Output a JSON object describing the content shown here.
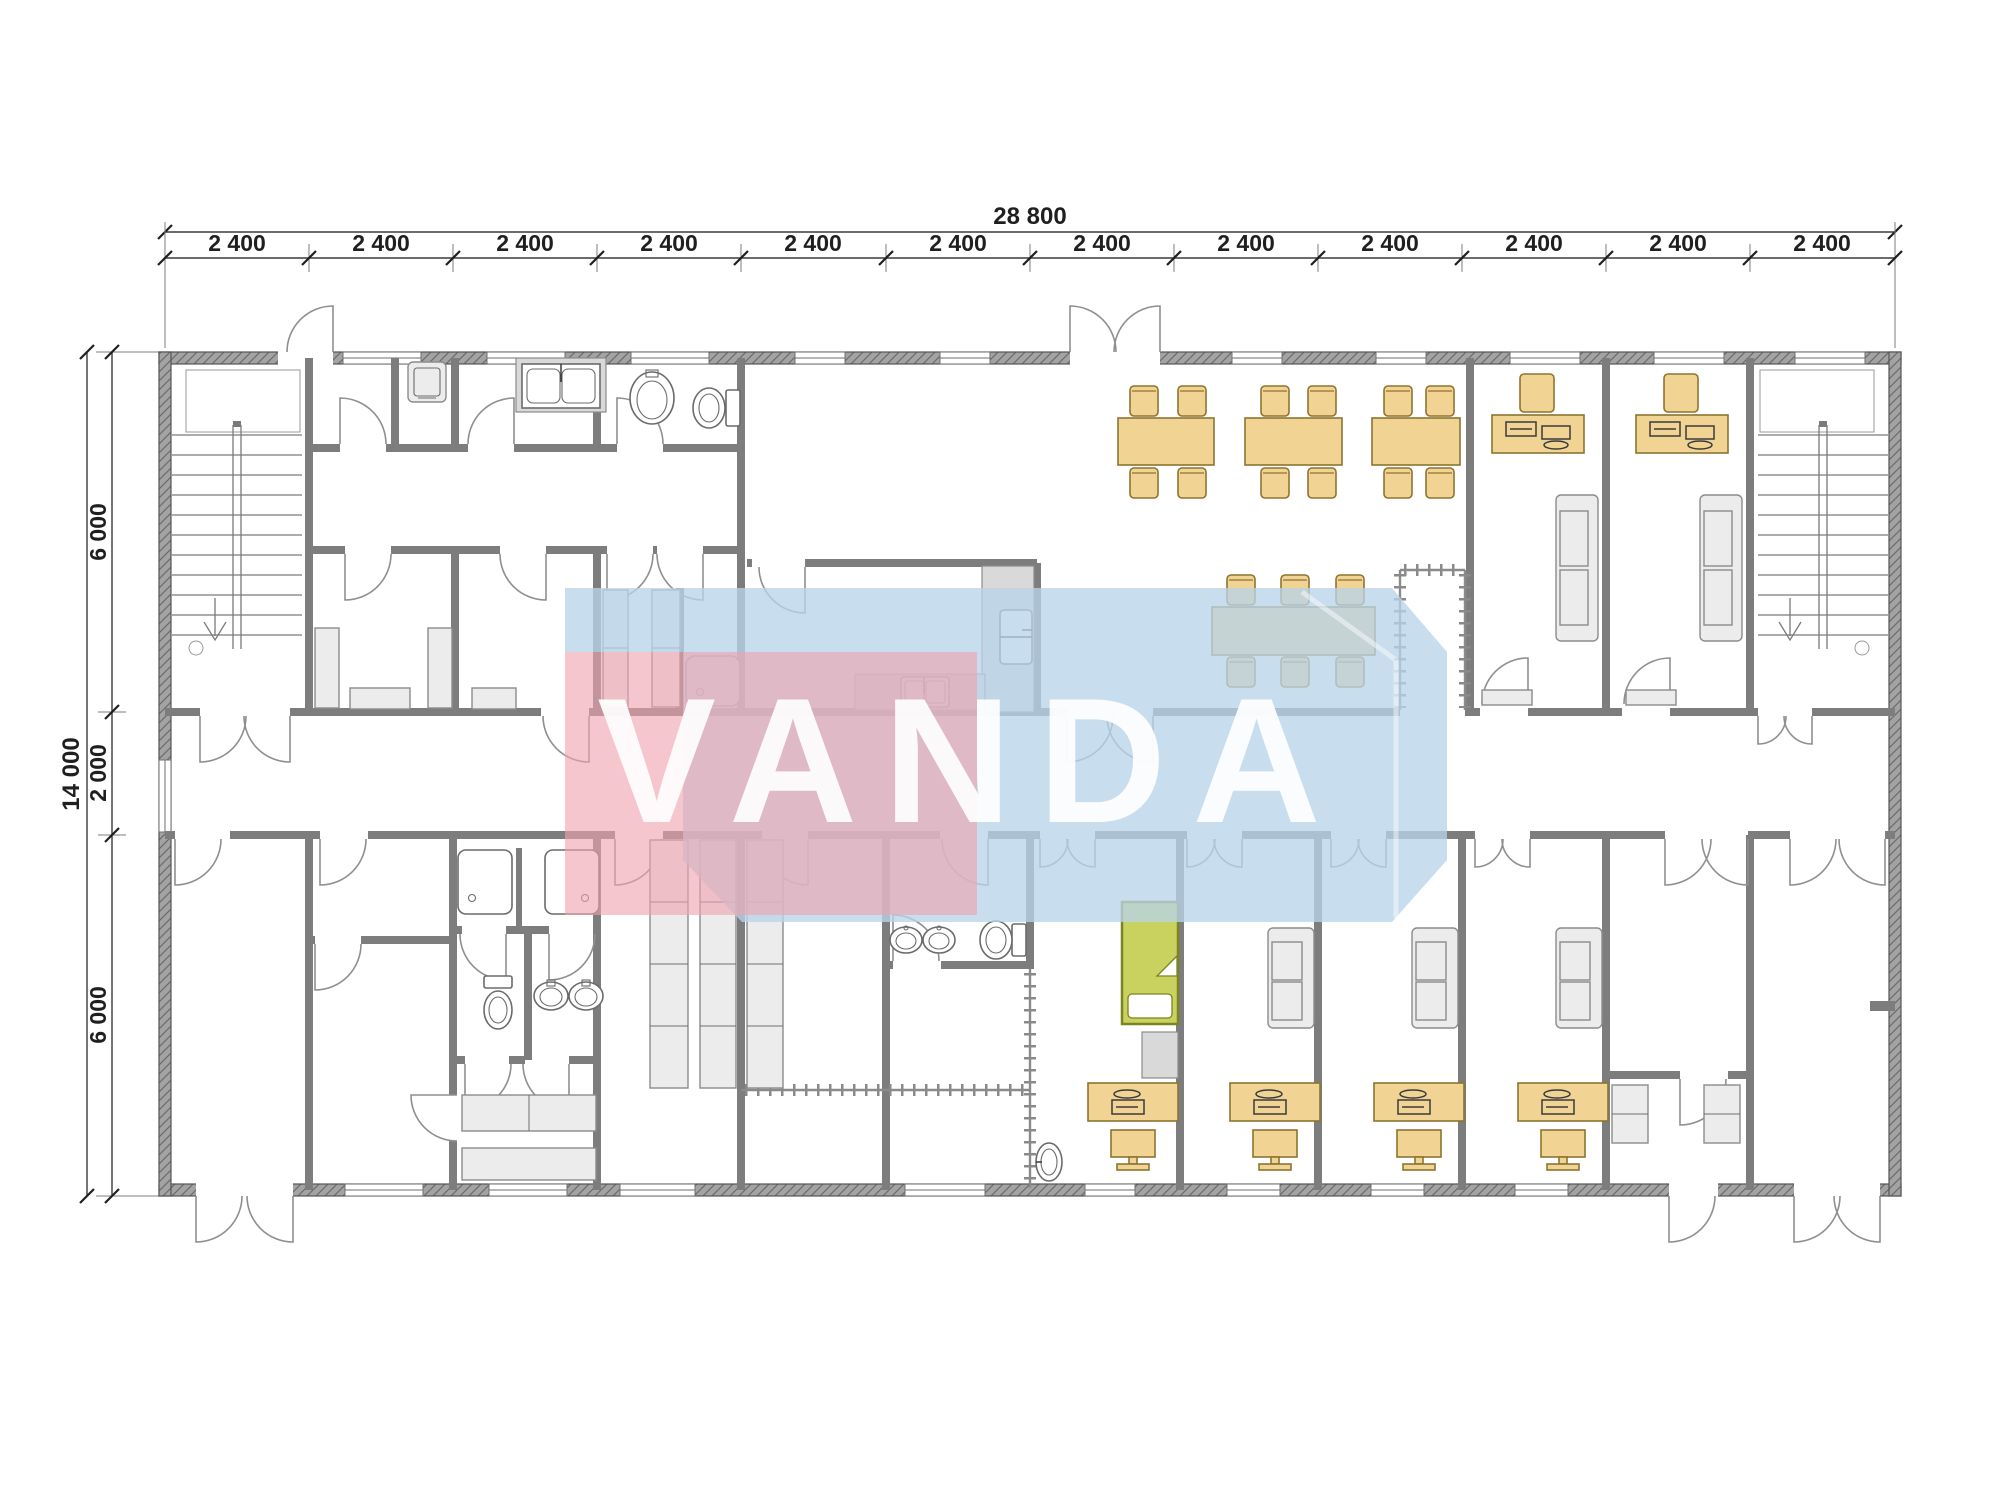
{
  "drawing": {
    "type": "floor-plan",
    "watermark": {
      "text": "VANDA",
      "blue": "#b9d3e8",
      "red": "#efa3b0",
      "letter_color": "#ffffff"
    },
    "dims": {
      "top_total": "28 800",
      "top_segments": [
        "2 400",
        "2 400",
        "2 400",
        "2 400",
        "2 400",
        "2 400",
        "2 400",
        "2 400",
        "2 400",
        "2 400",
        "2 400",
        "2 400"
      ],
      "left_total": "14 000",
      "left_segments": [
        "6 000",
        "2 000",
        "6 000"
      ]
    },
    "colors": {
      "wall": "#7d7d7d",
      "outer_wall": "#a3a3a3",
      "outer_hatch": "#6b6b6b",
      "furniture": "#f1d393",
      "furniture_stroke": "#8d742f",
      "gray_furniture": "#ececec",
      "fixture_stroke": "#6b6b6b",
      "bed": "#c9d15f",
      "bed_stroke": "#7c8321",
      "dim_text": "#1f1f1f"
    }
  }
}
